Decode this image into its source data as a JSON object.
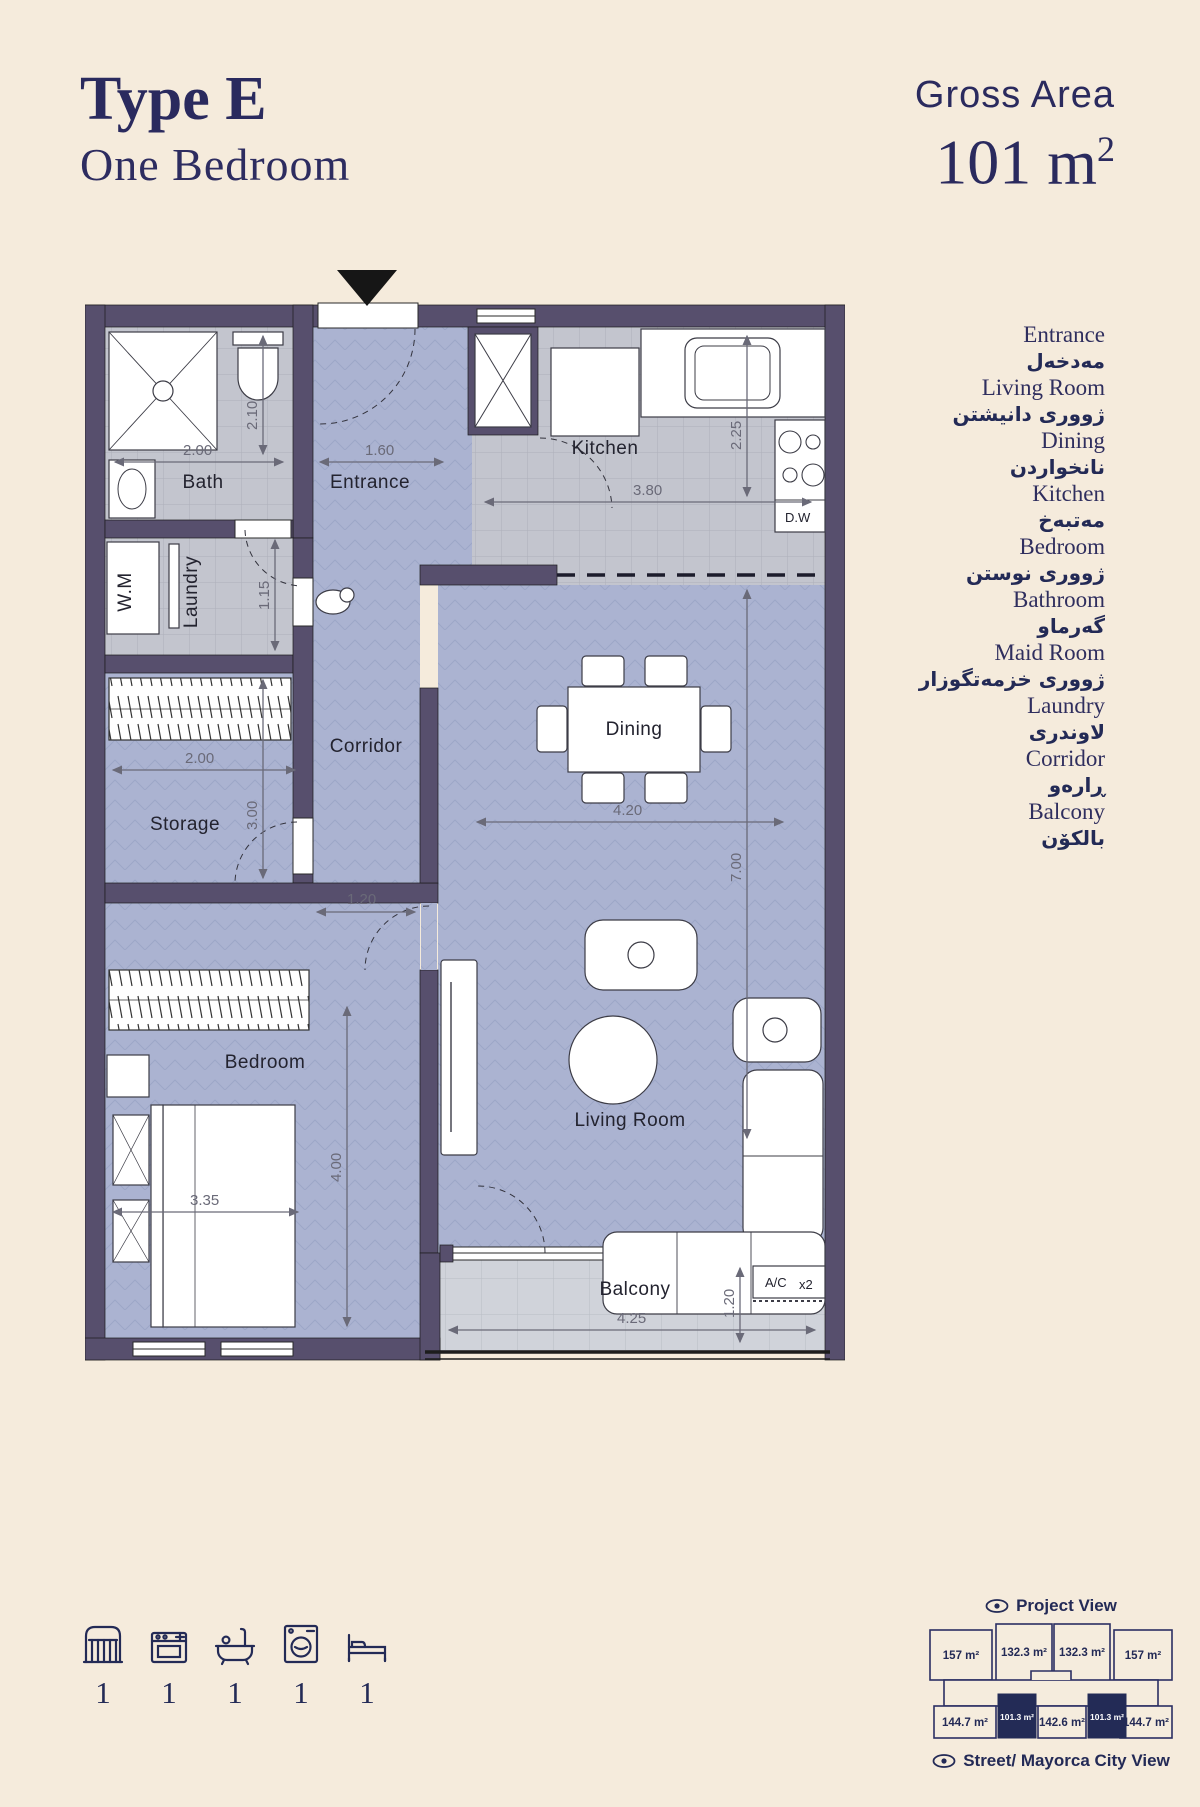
{
  "colors": {
    "background": "#f5ebdc",
    "accent_navy": "#2a2a5e",
    "wall_purple": "#574f6d",
    "floor_blue": "#abb3d1",
    "floor_gray": "#c3c5ce",
    "floor_balcony": "#d0d3da",
    "highlight_unit": "#232b56",
    "dimension_gray": "#6a6a78"
  },
  "header": {
    "title": "Type E",
    "subtitle": "One Bedroom",
    "gross_area_label": "Gross Area",
    "gross_area_value": "101 m",
    "gross_area_exp": "2"
  },
  "plan": {
    "labels": {
      "bath": "Bath",
      "entrance": "Entrance",
      "kitchen": "Kitchen",
      "dw": "D.W",
      "wm": "W.M",
      "laundry": "Laundry",
      "corridor": "Corridor",
      "storage": "Storage",
      "dining": "Dining",
      "bedroom": "Bedroom",
      "living": "Living Room",
      "balcony": "Balcony",
      "ac": "A/C",
      "ac_mult": "x2"
    },
    "dims": {
      "bath_w": "2.00",
      "bath_h": "2.10",
      "entrance_w": "1.60",
      "kitchen_w": "3.80",
      "kitchen_h": "2.25",
      "laundry_h": "1.15",
      "storage_w": "2.00",
      "storage_h": "3.00",
      "corridor_w": "1.20",
      "dining_w": "4.20",
      "living_h": "7.00",
      "bedroom_h": "4.00",
      "bedroom_w": "3.35",
      "balcony_w": "4.25",
      "balcony_h": "1.20"
    }
  },
  "legend": {
    "items": [
      {
        "en": "Entrance",
        "ku": "مەدخەل"
      },
      {
        "en": "Living Room",
        "ku": "ژوورى دانيشتن"
      },
      {
        "en": "Dining",
        "ku": "نانخواردن"
      },
      {
        "en": "Kitchen",
        "ku": "مەتبەخ"
      },
      {
        "en": "Bedroom",
        "ku": "ژوورى نوستن"
      },
      {
        "en": "Bathroom",
        "ku": "گەرماو"
      },
      {
        "en": "Maid Room",
        "ku": "ژوورى خزمەتگوزار"
      },
      {
        "en": "Laundry",
        "ku": "لاوندرى"
      },
      {
        "en": "Corridor",
        "ku": "ڕارەو"
      },
      {
        "en": "Balcony",
        "ku": "بالكۆن"
      }
    ]
  },
  "amenities": {
    "items": [
      {
        "name": "entrance-door",
        "count": "1"
      },
      {
        "name": "kitchen",
        "count": "1"
      },
      {
        "name": "bathtub",
        "count": "1"
      },
      {
        "name": "washing-machine",
        "count": "1"
      },
      {
        "name": "bed",
        "count": "1"
      }
    ]
  },
  "miniplan": {
    "top_view_label": "Project View",
    "bottom_view_label": "Street/ Mayorca City View",
    "top_units": [
      "157 m²",
      "132.3 m²",
      "132.3 m²",
      "157 m²"
    ],
    "bottom_units": [
      "144.7 m²",
      "101.3 m²",
      "142.6 m²",
      "101.3 m²",
      "144.7 m²"
    ]
  }
}
